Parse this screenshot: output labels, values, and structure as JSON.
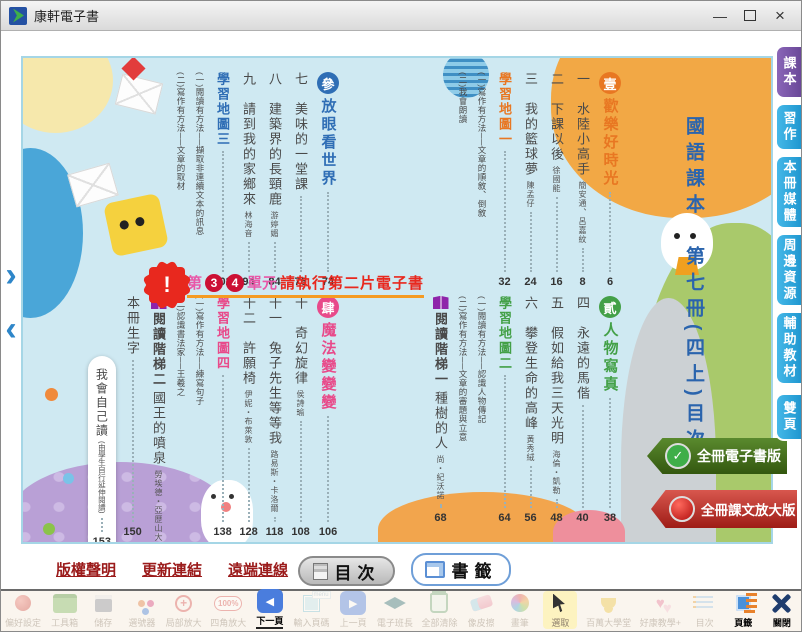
{
  "window": {
    "title": "康軒電子書",
    "controls": [
      "minimize-icon",
      "maximize-icon",
      "close-icon"
    ]
  },
  "page_nav": {
    "forward_icon": "forward-arrow-icon",
    "back_icon": "back-arrow-icon"
  },
  "side_tabs": {
    "items": [
      {
        "label": "課本",
        "active": true,
        "color": "#6a4898"
      },
      {
        "label": "習作",
        "active": false,
        "color": "#1f97d0"
      },
      {
        "label": "本冊媒體",
        "active": false,
        "color": "#1f97d0"
      },
      {
        "label": "周邊資源",
        "active": false,
        "color": "#1f97d0"
      },
      {
        "label": "輔助教材",
        "active": false,
        "color": "#1f97d0"
      },
      {
        "label": "雙頁",
        "active": false,
        "color": "#1f97d0"
      }
    ]
  },
  "toc": {
    "book_title": "國語課本　第七冊(四上)目次",
    "blocks": {
      "top_right": [
        {
          "type": "section",
          "badge": "壹",
          "title": "歡樂好時光",
          "page": "6",
          "color": "#e87722"
        },
        {
          "type": "lesson",
          "num": "一",
          "title": "水陸小高手",
          "author": "簡安通、呂嘉紋",
          "page": "8"
        },
        {
          "type": "lesson",
          "num": "二",
          "title": "下課以後",
          "author": "徐國能",
          "page": "16"
        },
        {
          "type": "lesson",
          "num": "三",
          "title": "我的籃球夢",
          "author": "陳孟仔",
          "page": "24"
        },
        {
          "type": "map",
          "title": "學習地圖一",
          "page": "32",
          "color": "#e87722"
        },
        {
          "type": "sub",
          "title": "(一)寫作有方法──文章的順敘、倒敘"
        },
        {
          "type": "sub",
          "title": "(二)我會朗讀"
        }
      ],
      "bottom_right": [
        {
          "type": "section",
          "badge": "貳",
          "title": "人物寫真",
          "page": "38",
          "color": "#43a047"
        },
        {
          "type": "lesson",
          "num": "四",
          "title": "永遠的馬偕",
          "page": "40"
        },
        {
          "type": "lesson",
          "num": "五",
          "title": "假如給我三天光明",
          "author": "海倫・凱勒",
          "page": "48"
        },
        {
          "type": "lesson",
          "num": "六",
          "title": "攀登生命的高峰",
          "author": "黃秀絨",
          "page": "56"
        },
        {
          "type": "map",
          "title": "學習地圖二",
          "page": "64",
          "color": "#43a047"
        },
        {
          "type": "sub",
          "title": "(一)閱讀有方法──認識人物傳記"
        },
        {
          "type": "sub",
          "title": "(二)寫作有方法──文章的審題與立意"
        },
        {
          "type": "ladder",
          "title": "閱讀階梯一",
          "sub": "種樹的人",
          "author": "尚・紀沃諾",
          "page": "68",
          "color": "#8e24aa"
        }
      ],
      "top_left": [
        {
          "type": "section",
          "badge": "參",
          "title": "放眼看世界",
          "page": "74",
          "color": "#2f6eb5"
        },
        {
          "type": "lesson",
          "num": "七",
          "title": "美味的一堂課",
          "page": "76"
        },
        {
          "type": "lesson",
          "num": "八",
          "title": "建築界的長頸鹿",
          "author": "游婷媚",
          "page": "84"
        },
        {
          "type": "lesson",
          "num": "九",
          "title": "請到我的家鄉來",
          "author": "林海音",
          "page": "94"
        },
        {
          "type": "map",
          "title": "學習地圖三",
          "page": "102",
          "color": "#2f6eb5"
        },
        {
          "type": "sub",
          "title": "(一)閱讀有方法──擷取非連續文本的訊息"
        },
        {
          "type": "sub",
          "title": "(二)寫作有方法──文章的取材"
        }
      ],
      "bottom_left": [
        {
          "type": "section",
          "badge": "肆",
          "title": "魔法變變變",
          "page": "106",
          "color": "#e84a8a"
        },
        {
          "type": "lesson",
          "num": "十",
          "title": "奇幻旋律",
          "author": "侯詩瑜",
          "page": "108"
        },
        {
          "type": "lesson",
          "num": "十一",
          "title": "兔子先生等等我",
          "author": "路易斯・卡洛爾",
          "page": "118"
        },
        {
          "type": "lesson",
          "num": "十二",
          "title": "許願椅",
          "author": "伊妮・布萊敦",
          "page": "128"
        },
        {
          "type": "map",
          "title": "學習地圖四",
          "page": "138",
          "color": "#e84a8a"
        },
        {
          "type": "sub",
          "title": "(一)寫作有方法──練寫句子"
        },
        {
          "type": "sub",
          "title": "(二)認識書法家──王羲之"
        },
        {
          "type": "ladder",
          "title": "閱讀階梯二",
          "sub": "國王的噴泉",
          "author": "勞埃德・亞歷山大",
          "page": "142",
          "color": "#8e24aa"
        },
        {
          "type": "plain",
          "title": "本冊生字",
          "page": "150"
        },
        {
          "type": "bookmark",
          "title": "我會自己讀",
          "sub": "(由學生自行延伸閱讀)",
          "page": "153"
        }
      ]
    }
  },
  "warning": {
    "prefix": "第",
    "unit1": "3",
    "unit2": "4",
    "middle": "單元",
    "message": "請執行第二片電子書",
    "underline_color": "#f59b22"
  },
  "ribbons": [
    {
      "label": "全冊電子書版",
      "icon": "check-badge-icon",
      "color": "#33570f"
    },
    {
      "label": "全冊課文放大版",
      "icon": "record-badge-icon",
      "color": "#9e1c16"
    }
  ],
  "footer": {
    "links": [
      "版權聲明",
      "更新連結",
      "遠端連線",
      "安裝字型"
    ]
  },
  "bottom_tabs": [
    {
      "label": "目次",
      "icon": "toc-panel-icon",
      "active": true
    },
    {
      "label": "書籤",
      "icon": "bookmark-panel-icon",
      "active": false
    }
  ],
  "toolbar": {
    "items": [
      {
        "label": "偏好設定",
        "icon": "settings-icon",
        "faded": true
      },
      {
        "label": "工具箱",
        "icon": "toolbox-icon",
        "faded": true
      },
      {
        "label": "儲存",
        "icon": "save-icon",
        "faded": true
      },
      {
        "label": "選號器",
        "icon": "picker-icon",
        "faded": true
      },
      {
        "label": "局部放大",
        "icon": "zoom-partial-icon",
        "faded": true
      },
      {
        "label": "四角放大",
        "icon": "zoom-corner-icon",
        "faded": true
      },
      {
        "label": "下一頁",
        "icon": "next-page-icon",
        "active": true,
        "underline": true
      },
      {
        "label": "輸入頁碼",
        "icon": "page-input-icon",
        "faded": true
      },
      {
        "label": "上一頁",
        "icon": "prev-page-icon",
        "faded": true
      },
      {
        "label": "電子班長",
        "icon": "class-leader-icon",
        "faded": true
      },
      {
        "label": "全部清除",
        "icon": "clear-all-icon",
        "faded": true
      },
      {
        "label": "像皮擦",
        "icon": "eraser-icon",
        "faded": true
      },
      {
        "label": "畫筆",
        "icon": "paint-icon",
        "faded": true
      },
      {
        "label": "選取",
        "icon": "select-icon",
        "highlighted": true
      },
      {
        "label": "百萬大學堂",
        "icon": "trophy-icon",
        "faded": true
      },
      {
        "label": "好康教學+",
        "icon": "teaching-plus-icon",
        "faded": true
      },
      {
        "label": "目次",
        "icon": "toc-icon",
        "faded": true
      },
      {
        "label": "頁籤",
        "icon": "page-tabs-icon",
        "active": true
      },
      {
        "label": "關閉",
        "icon": "close-app-icon",
        "active": true
      }
    ]
  }
}
